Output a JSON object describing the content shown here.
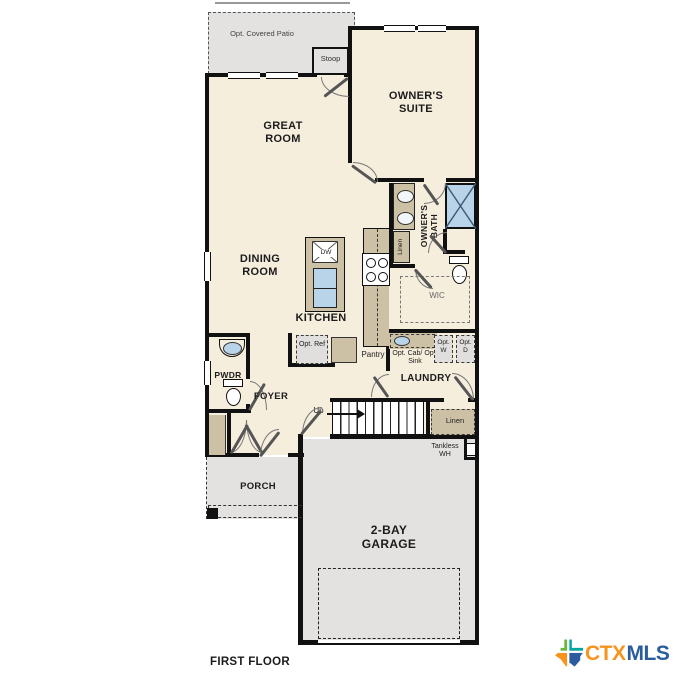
{
  "plan": {
    "patio": "Opt. Covered Patio",
    "stoop": "Stoop",
    "owners_suite": "OWNER'S SUITE",
    "great_room": "GREAT ROOM",
    "dining_room": "DINING ROOM",
    "kitchen": "KITCHEN",
    "owners_bath": "OWNER'S BATH",
    "linen_bath": "Linen",
    "wic": "WIC",
    "opt_ref": "Opt. Ref",
    "pantry": "Pantry",
    "opt_cab_sink": "Opt. Cab/ Opt. Sink",
    "opt_w": "Opt. W",
    "opt_d": "Opt. D",
    "laundry": "LAUNDRY",
    "pwdr": "PWDR",
    "foyer": "FOYER",
    "up": "Up",
    "linen_stairs": "Linen",
    "tankless": "Tankless WH",
    "garage": "2-BAY GARAGE",
    "porch": "PORCH",
    "dishwasher": "DW"
  },
  "footer": {
    "label": "FIRST FLOOR"
  },
  "logo": {
    "ctx": "CTX",
    "mls": "MLS"
  },
  "colors": {
    "interior": "#f6eedd",
    "exterior_gray": "#e3e2e0",
    "cabinet_tan": "#cdc1a5",
    "fixture_blue": "#b9d3e8",
    "wall": "#111111",
    "logo_orange": "#f7941d",
    "logo_blue": "#2b5d9e",
    "logo_green": "#6cb33f",
    "logo_teal": "#00a79d"
  }
}
